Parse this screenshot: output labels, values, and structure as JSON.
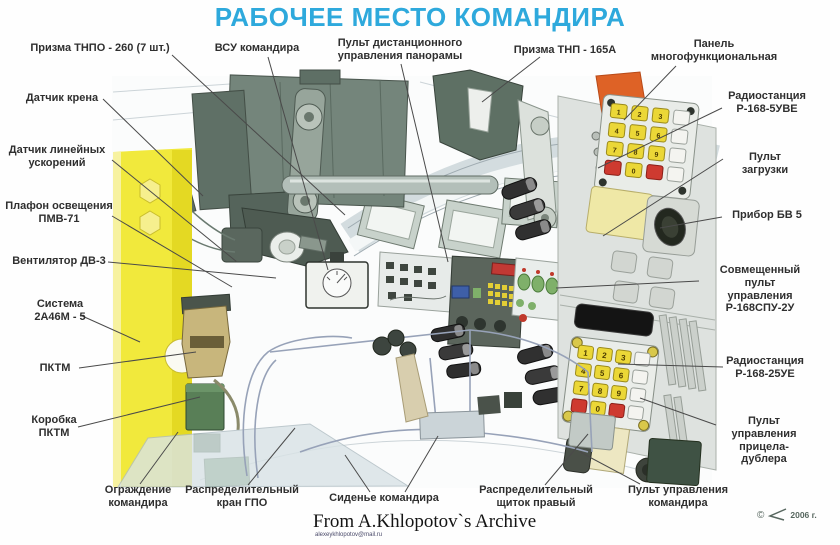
{
  "title": {
    "text": "РАБОЧЕЕ МЕСТО КОМАНДИРА",
    "color": "#2ea9dc"
  },
  "labels": [
    {
      "id": "prism-tnpo-260",
      "text": "Призма ТНПО - 260 (7 шт.)",
      "x": 100,
      "y": 42
    },
    {
      "id": "vsu-commander",
      "text": "ВСУ командира",
      "x": 257,
      "y": 42
    },
    {
      "id": "panorama-remote",
      "text": "Пульт дистанционного\nуправления панорамы",
      "x": 400,
      "y": 37
    },
    {
      "id": "prism-tnp-165a",
      "text": "Призма ТНП - 165А",
      "x": 565,
      "y": 44
    },
    {
      "id": "multifunction-panel",
      "text": "Панель\nмногофункциональная",
      "x": 714,
      "y": 38
    },
    {
      "id": "radio-r168-5uve",
      "text": "Радиостанция\nР-168-5УВЕ",
      "x": 767,
      "y": 90
    },
    {
      "id": "loading-console",
      "text": "Пульт загрузки",
      "x": 765,
      "y": 151
    },
    {
      "id": "device-bv5",
      "text": "Прибор БВ 5",
      "x": 767,
      "y": 209
    },
    {
      "id": "combined-control-console",
      "text": "Совмещенный пульт\nуправления\nР-168СПУ-2У",
      "x": 760,
      "y": 264
    },
    {
      "id": "radio-r168-25ue",
      "text": "Радиостанция\nР-168-25УЕ",
      "x": 765,
      "y": 355
    },
    {
      "id": "backup-sight-console",
      "text": "Пульт управления\nприцела-дублера",
      "x": 764,
      "y": 415
    },
    {
      "id": "tilt-sensor",
      "text": "Датчик крена",
      "x": 62,
      "y": 92
    },
    {
      "id": "linear-accel-sensor",
      "text": "Датчик линейных\nускорений",
      "x": 57,
      "y": 144
    },
    {
      "id": "lamp-pmv71",
      "text": "Плафон освещения\nПМВ-71",
      "x": 59,
      "y": 200
    },
    {
      "id": "fan-dv3",
      "text": "Вентилятор ДВ-3",
      "x": 59,
      "y": 255
    },
    {
      "id": "system-2a46m5",
      "text": "Система\n2А46М - 5",
      "x": 60,
      "y": 298
    },
    {
      "id": "pktm",
      "text": "ПКТМ",
      "x": 55,
      "y": 362
    },
    {
      "id": "pktm-box",
      "text": "Коробка\nПКТМ",
      "x": 54,
      "y": 414
    },
    {
      "id": "commander-guard",
      "text": "Ограждение\nкомандира",
      "x": 138,
      "y": 484
    },
    {
      "id": "gpo-valve",
      "text": "Распределительный\nкран ГПО",
      "x": 242,
      "y": 484
    },
    {
      "id": "commander-seat",
      "text": "Сиденье командира",
      "x": 384,
      "y": 492
    },
    {
      "id": "right-distribution-panel",
      "text": "Распределительный\nщиток правый",
      "x": 536,
      "y": 484
    },
    {
      "id": "commander-control-console",
      "text": "Пульт управления\nкомандира",
      "x": 678,
      "y": 484
    }
  ],
  "leaders": [
    [
      172,
      55,
      345,
      215
    ],
    [
      268,
      57,
      328,
      270
    ],
    [
      401,
      64,
      448,
      262
    ],
    [
      540,
      57,
      482,
      102
    ],
    [
      676,
      66,
      624,
      120
    ],
    [
      722,
      108,
      598,
      168
    ],
    [
      723,
      159,
      603,
      236
    ],
    [
      722,
      217,
      660,
      228
    ],
    [
      699,
      281,
      556,
      288
    ],
    [
      723,
      367,
      618,
      364
    ],
    [
      716,
      425,
      640,
      398
    ],
    [
      103,
      99,
      203,
      196
    ],
    [
      112,
      160,
      237,
      262
    ],
    [
      112,
      216,
      232,
      287
    ],
    [
      108,
      262,
      276,
      278
    ],
    [
      80,
      315,
      140,
      342
    ],
    [
      79,
      368,
      196,
      352
    ],
    [
      78,
      427,
      200,
      397
    ],
    [
      140,
      484,
      178,
      432
    ],
    [
      248,
      485,
      295,
      428
    ],
    [
      370,
      492,
      345,
      455
    ],
    [
      405,
      492,
      438,
      436
    ],
    [
      545,
      485,
      588,
      434
    ],
    [
      640,
      484,
      580,
      452
    ]
  ],
  "keypad": {
    "digits_rows": [
      [
        "1",
        "2",
        "3"
      ],
      [
        "4",
        "5",
        "6"
      ],
      [
        "7",
        "8",
        "9"
      ],
      [
        "",
        "0",
        ""
      ]
    ]
  },
  "footer": {
    "credit": "From A.Khlopotov`s Archive",
    "email": "alexeykhlopotov@mail.ru",
    "copyright": "©",
    "year": "2006 г."
  },
  "colors": {
    "title_blue": "#2ea9dc",
    "label_text": "#2f2f2f",
    "gun_panel_yellow": "#f1e93c",
    "machinery_green": "#72837a",
    "orange_accent": "#de6226",
    "key_yellow": "#ebd737",
    "key_red": "#ce3a30",
    "display_black": "#141414"
  },
  "icons": [
    "chevron-logo-icon",
    "turret-ring",
    "prism-blocks",
    "vsu-sight-device",
    "keypad-multifunction",
    "keypad-radio",
    "commander-seat-frame",
    "joystick"
  ]
}
